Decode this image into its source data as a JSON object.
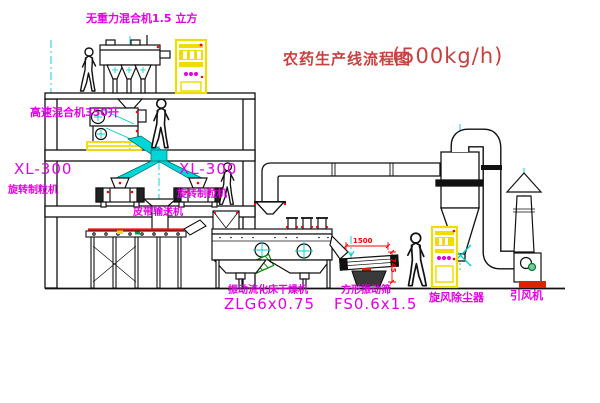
{
  "diagram": {
    "title": {
      "zh": "农药生产线流程图",
      "capacity": "(500kg/h)"
    },
    "labels": {
      "gravity_mixer": "无重力混合机1.5 立方",
      "speed_mixer": "高速混合机350升",
      "xl300_a": "XL-300",
      "granulator_a": "旋转制粒机",
      "xl300_b": "XL-300",
      "granulator_b": "旋转制粒机",
      "belt": "皮带输送机",
      "dryer_name": "振动流化床干燥机",
      "dryer_model": "ZLG6x0.75",
      "screen_name": "方形振动筛",
      "screen_model": "FS0.6x1.5",
      "cyclone": "旋风除尘器",
      "fan": "引风机"
    },
    "dimensions": {
      "screen_length": "1500",
      "screen_height": "745"
    },
    "colors": {
      "label_magenta": "#e400e4",
      "title_red": "#c94040",
      "dimension_red": "#ff0000",
      "centerline_cyan": "#00cccc",
      "cabinet_yellow": "#f0dd00",
      "motor_green": "#007a30",
      "line_black": "#111111",
      "background": "#ffffff"
    }
  }
}
